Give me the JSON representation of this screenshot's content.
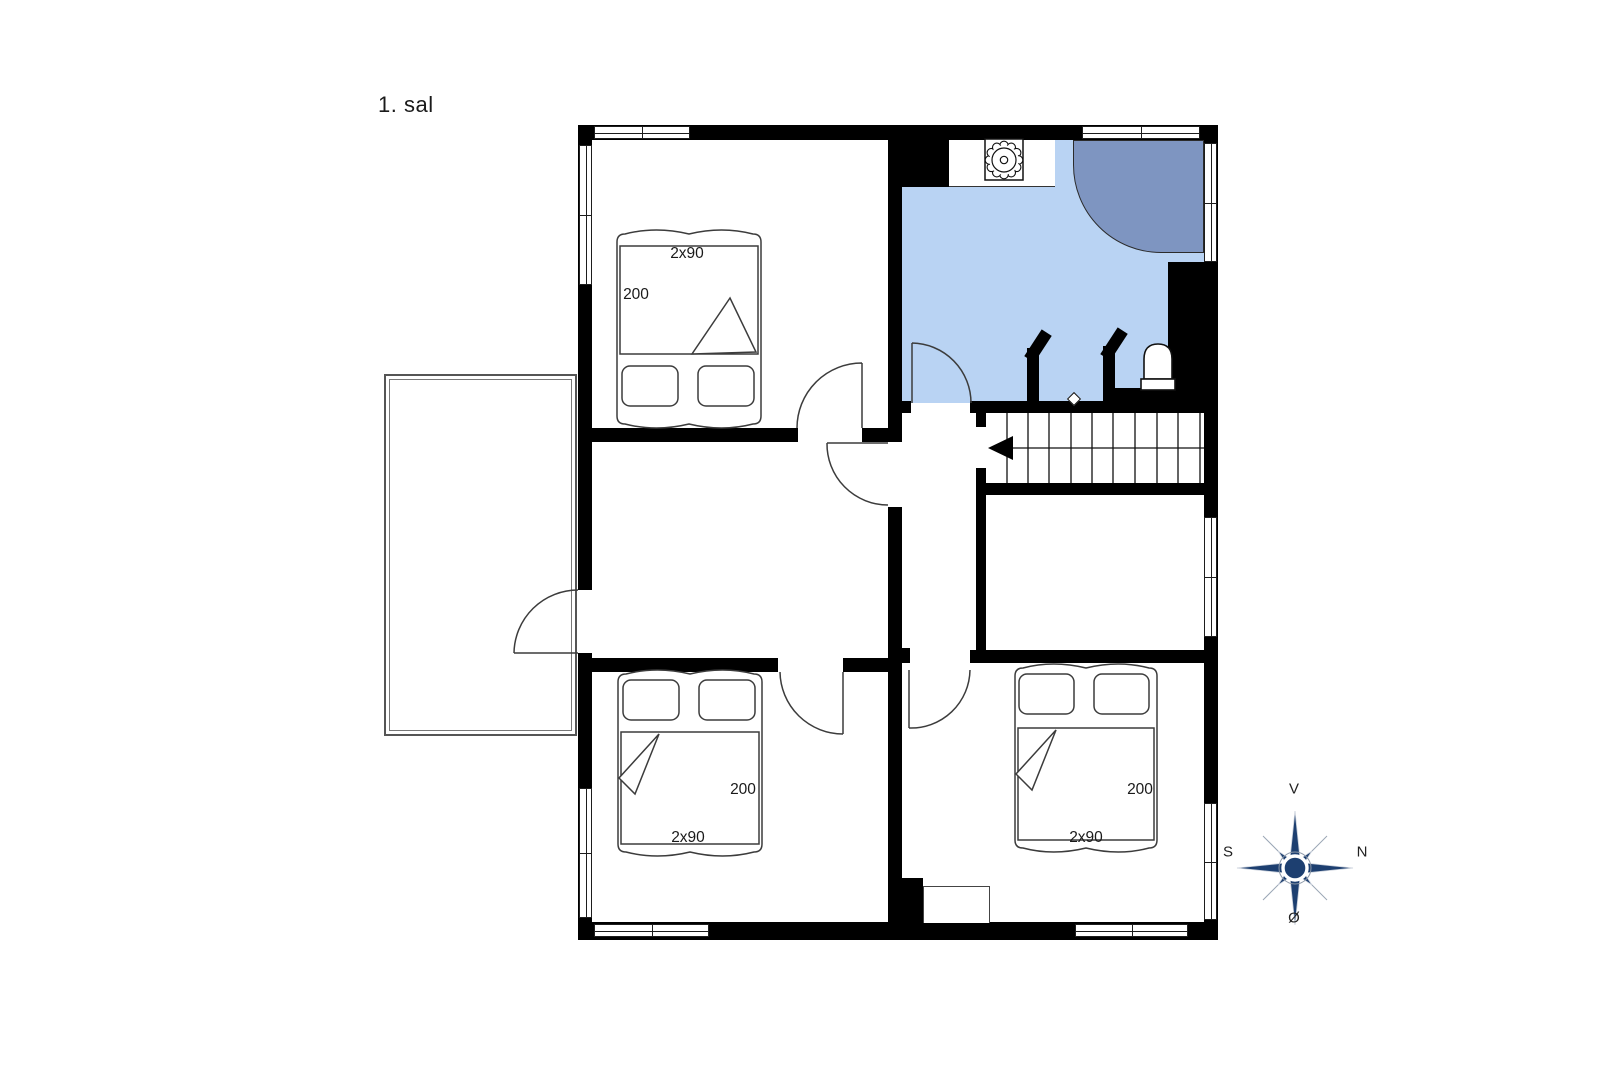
{
  "page": {
    "title": "1. sal"
  },
  "plan": {
    "beds": {
      "top_left": {
        "width_label": "2x90",
        "length_label": "200"
      },
      "bottom_left": {
        "width_label": "2x90",
        "length_label": "200"
      },
      "bottom_right": {
        "width_label": "2x90",
        "length_label": "200"
      }
    },
    "compass": {
      "top": "V",
      "right": "N",
      "left": "S",
      "bottom": "Ø"
    },
    "colors": {
      "bathroom_floor": "#b9d3f3",
      "shower": "#7e95c1",
      "wall": "#000000",
      "compass_navy": "#1d3f70"
    }
  }
}
